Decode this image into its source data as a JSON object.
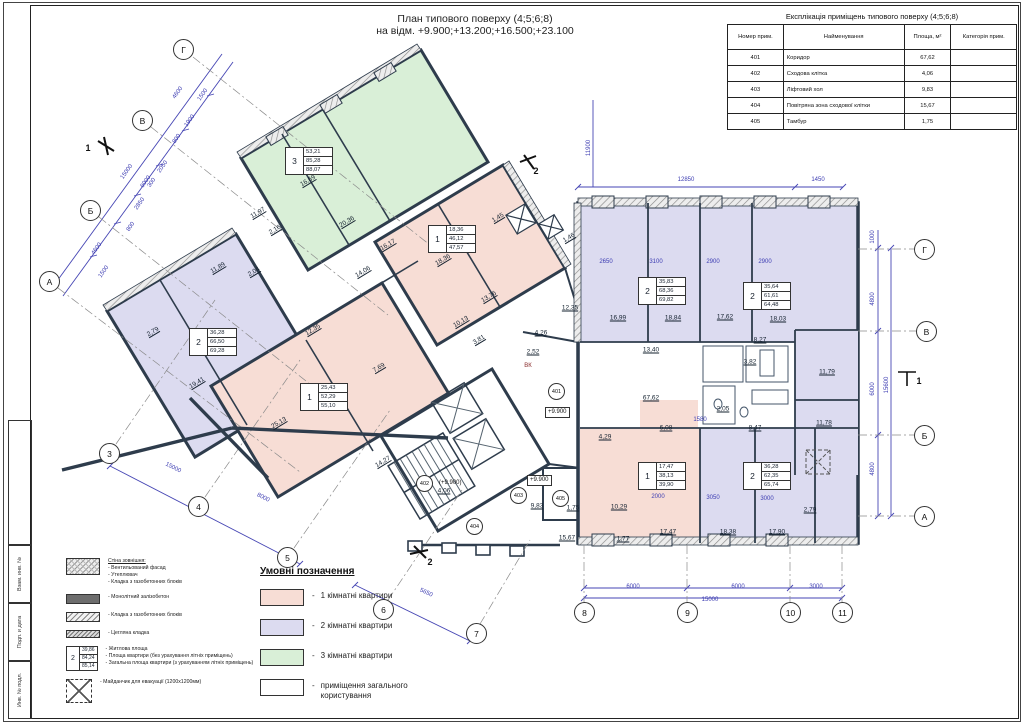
{
  "title": {
    "line1": "План типового поверху (4;5;6;8)",
    "line2": "на відм. +9.900;+13.200;+16.500;+23.100"
  },
  "stamp": {
    "fields": [
      "Взам. инв. №",
      "Подп. и дата",
      "Инв. № подл."
    ]
  },
  "expl_table": {
    "title": "Експлікація приміщень типового поверху (4;5;6;8)",
    "columns": [
      "Номер прим.",
      "Найменування",
      "Площа, м²",
      "Категорія прим."
    ],
    "rows": [
      [
        "401",
        "Коридор",
        "67,62",
        ""
      ],
      [
        "402",
        "Сходова клітка",
        "4,06",
        ""
      ],
      [
        "403",
        "Ліфтовий хол",
        "9,83",
        ""
      ],
      [
        "404",
        "Повітряна зона сходової клітки",
        "15,67",
        ""
      ],
      [
        "405",
        "Тамбур",
        "1,75",
        ""
      ]
    ]
  },
  "legend": {
    "title": "Умовні позначення",
    "items": [
      {
        "color": "#f7ddd5",
        "label": "1 кімнатні квартири"
      },
      {
        "color": "#dcdbf0",
        "label": "2 кімнатні квартири"
      },
      {
        "color": "#d9efd7",
        "label": "3 кімнатні квартири"
      },
      {
        "color": "#ffffff",
        "label": "приміщення загального користування"
      }
    ]
  },
  "materials": {
    "items": [
      {
        "swatch": "sw-wallext",
        "lines": [
          "Стіна зовнішня:",
          "- Вентильований фасад",
          "- Утеплювач",
          "- Кладка з газобетонних блоків"
        ]
      },
      {
        "swatch": "sw-conc",
        "lines": [
          "- Монолітний залізобетон"
        ]
      },
      {
        "swatch": "sw-aer",
        "lines": [
          "- Кладка з газобетонних блоків"
        ]
      },
      {
        "swatch": "sw-brick",
        "lines": [
          "- Цегляна кладка"
        ]
      },
      {
        "swatch": "mini-tag",
        "tag": {
          "num": "2",
          "values": [
            "39,86",
            "84,24",
            "85,14"
          ]
        },
        "lines": [
          "- Житлова площа",
          "- Площа квартири (без урахування літніх приміщень)",
          "- Загальна площа квартири (з урахуванням літніх приміщень)"
        ]
      },
      {
        "swatch": "sw-evac",
        "lines": [
          "- Майданчик для евакуації (1200х1200мм)"
        ]
      }
    ]
  },
  "plan": {
    "axes": [
      {
        "label": "Г",
        "x": 183,
        "y": 49
      },
      {
        "label": "В",
        "x": 142,
        "y": 120
      },
      {
        "label": "Б",
        "x": 90,
        "y": 210
      },
      {
        "label": "А",
        "x": 49,
        "y": 281
      },
      {
        "label": "3",
        "x": 109,
        "y": 453
      },
      {
        "label": "4",
        "x": 198,
        "y": 506
      },
      {
        "label": "5",
        "x": 287,
        "y": 557
      },
      {
        "label": "6",
        "x": 383,
        "y": 609
      },
      {
        "label": "7",
        "x": 476,
        "y": 633
      },
      {
        "label": "8",
        "x": 584,
        "y": 612
      },
      {
        "label": "9",
        "x": 687,
        "y": 612
      },
      {
        "label": "10",
        "x": 790,
        "y": 612
      },
      {
        "label": "11",
        "x": 842,
        "y": 612
      },
      {
        "label": "Г",
        "x": 924,
        "y": 249
      },
      {
        "label": "В",
        "x": 926,
        "y": 331
      },
      {
        "label": "Б",
        "x": 924,
        "y": 435
      },
      {
        "label": "А",
        "x": 924,
        "y": 516
      }
    ],
    "apt_tags": [
      {
        "num": "3",
        "values": [
          "53,21",
          "85,28",
          "88,07"
        ],
        "x": 285,
        "y": 147
      },
      {
        "num": "2",
        "values": [
          "36,28",
          "66,50",
          "69,28"
        ],
        "x": 189,
        "y": 328
      },
      {
        "num": "1",
        "values": [
          "25,43",
          "52,29",
          "55,10"
        ],
        "x": 300,
        "y": 383
      },
      {
        "num": "1",
        "values": [
          "18,36",
          "46,12",
          "47,57"
        ],
        "x": 428,
        "y": 225
      },
      {
        "num": "2",
        "values": [
          "35,83",
          "68,36",
          "69,82"
        ],
        "x": 638,
        "y": 277
      },
      {
        "num": "2",
        "values": [
          "35,64",
          "61,61",
          "64,48"
        ],
        "x": 743,
        "y": 282
      },
      {
        "num": "1",
        "values": [
          "17,47",
          "38,13",
          "39,90"
        ],
        "x": 638,
        "y": 462
      },
      {
        "num": "2",
        "values": [
          "36,28",
          "62,35",
          "65,74"
        ],
        "x": 743,
        "y": 462
      }
    ],
    "room_circles": [
      {
        "t": "401",
        "x": 556,
        "y": 391
      },
      {
        "t": "402",
        "x": 424,
        "y": 483
      },
      {
        "t": "403",
        "x": 518,
        "y": 495
      },
      {
        "t": "404",
        "x": 474,
        "y": 526
      },
      {
        "t": "405",
        "x": 560,
        "y": 498
      }
    ],
    "elev_marks": [
      {
        "t": "+9.900",
        "x": 545,
        "y": 412,
        "box": true
      },
      {
        "t": "+9.900",
        "x": 527,
        "y": 480,
        "box": true
      },
      {
        "t": "(+9.900)",
        "x": 437,
        "y": 484,
        "box": false
      }
    ],
    "labels": [
      {
        "t": "16,69",
        "x": 308,
        "y": 181,
        "r": -31,
        "c": "a"
      },
      {
        "t": "20,36",
        "x": 347,
        "y": 222,
        "r": -31,
        "c": "a"
      },
      {
        "t": "11,97",
        "x": 258,
        "y": 213,
        "r": -31,
        "c": "a"
      },
      {
        "t": "16,17",
        "x": 388,
        "y": 245,
        "r": -31,
        "c": "a"
      },
      {
        "t": "14,06",
        "x": 363,
        "y": 272,
        "r": -31,
        "c": "a"
      },
      {
        "t": "2,16",
        "x": 275,
        "y": 230,
        "r": -31,
        "c": "a"
      },
      {
        "t": "11,89",
        "x": 218,
        "y": 268,
        "r": -31,
        "c": "a"
      },
      {
        "t": "2,04",
        "x": 254,
        "y": 272,
        "r": -31,
        "c": "a"
      },
      {
        "t": "19,41",
        "x": 197,
        "y": 383,
        "r": -31,
        "c": "a"
      },
      {
        "t": "2,79",
        "x": 153,
        "y": 332,
        "r": -31,
        "c": "a"
      },
      {
        "t": "25,13",
        "x": 279,
        "y": 423,
        "r": -31,
        "c": "a"
      },
      {
        "t": "7,69",
        "x": 379,
        "y": 368,
        "r": -31,
        "c": "a"
      },
      {
        "t": "14,27",
        "x": 383,
        "y": 462,
        "r": -31,
        "c": "a"
      },
      {
        "t": "18,36",
        "x": 443,
        "y": 260,
        "r": -31,
        "c": "a"
      },
      {
        "t": "13,76",
        "x": 489,
        "y": 297,
        "r": -31,
        "c": "a"
      },
      {
        "t": "10,13",
        "x": 461,
        "y": 322,
        "r": -31,
        "c": "a"
      },
      {
        "t": "3,81",
        "x": 479,
        "y": 340,
        "r": -31,
        "c": "a"
      },
      {
        "t": "12,35",
        "x": 313,
        "y": 330,
        "r": -31,
        "c": "a"
      },
      {
        "t": "1,45",
        "x": 498,
        "y": 218,
        "r": -31,
        "c": "a"
      },
      {
        "t": "1,46",
        "x": 569,
        "y": 238,
        "r": -31,
        "c": "a"
      },
      {
        "t": "4,26",
        "x": 541,
        "y": 333,
        "c": "a"
      },
      {
        "t": "2,52",
        "x": 533,
        "y": 352,
        "c": "a"
      },
      {
        "t": "12,35",
        "x": 570,
        "y": 308,
        "c": "a"
      },
      {
        "t": "4,06",
        "x": 444,
        "y": 491,
        "c": "a"
      },
      {
        "t": "9,83",
        "x": 537,
        "y": 506,
        "c": "a"
      },
      {
        "t": "1,75",
        "x": 573,
        "y": 508,
        "c": "a"
      },
      {
        "t": "15,67",
        "x": 567,
        "y": 538,
        "c": "a"
      },
      {
        "t": "4,29",
        "x": 605,
        "y": 437,
        "c": "a"
      },
      {
        "t": "16,99",
        "x": 618,
        "y": 318,
        "c": "a"
      },
      {
        "t": "18,84",
        "x": 673,
        "y": 318,
        "c": "a"
      },
      {
        "t": "13,40",
        "x": 651,
        "y": 350,
        "c": "a"
      },
      {
        "t": "17,62",
        "x": 725,
        "y": 317,
        "c": "a"
      },
      {
        "t": "18,03",
        "x": 778,
        "y": 319,
        "c": "a"
      },
      {
        "t": "8,27",
        "x": 760,
        "y": 340,
        "c": "a"
      },
      {
        "t": "3,82",
        "x": 750,
        "y": 362,
        "c": "a"
      },
      {
        "t": "2,05",
        "x": 723,
        "y": 409,
        "c": "a"
      },
      {
        "t": "67,62",
        "x": 651,
        "y": 398,
        "c": "a"
      },
      {
        "t": "6,08",
        "x": 666,
        "y": 428,
        "c": "a"
      },
      {
        "t": "8,47",
        "x": 755,
        "y": 428,
        "c": "a"
      },
      {
        "t": "11,79",
        "x": 827,
        "y": 372,
        "c": "a"
      },
      {
        "t": "11,78",
        "x": 824,
        "y": 423,
        "c": "a"
      },
      {
        "t": "17,47",
        "x": 668,
        "y": 532,
        "c": "a"
      },
      {
        "t": "18,38",
        "x": 728,
        "y": 532,
        "c": "a"
      },
      {
        "t": "17,90",
        "x": 777,
        "y": 532,
        "c": "a"
      },
      {
        "t": "10,29",
        "x": 619,
        "y": 507,
        "c": "a"
      },
      {
        "t": "1,77",
        "x": 623,
        "y": 539,
        "c": "a"
      },
      {
        "t": "2,79",
        "x": 810,
        "y": 510,
        "c": "a"
      },
      {
        "t": "6000",
        "x": 633,
        "y": 587,
        "c": "d"
      },
      {
        "t": "6000",
        "x": 738,
        "y": 587,
        "c": "d"
      },
      {
        "t": "3000",
        "x": 816,
        "y": 587,
        "c": "d"
      },
      {
        "t": "15000",
        "x": 710,
        "y": 600,
        "c": "d"
      },
      {
        "t": "12850",
        "x": 686,
        "y": 180,
        "c": "d"
      },
      {
        "t": "1450",
        "x": 818,
        "y": 180,
        "c": "d"
      },
      {
        "t": "11900",
        "x": 589,
        "y": 148,
        "r": -90,
        "c": "d"
      },
      {
        "t": "1000",
        "x": 873,
        "y": 237,
        "r": -90,
        "c": "d"
      },
      {
        "t": "4800",
        "x": 873,
        "y": 299,
        "r": -90,
        "c": "d"
      },
      {
        "t": "6000",
        "x": 873,
        "y": 389,
        "r": -90,
        "c": "d"
      },
      {
        "t": "4800",
        "x": 873,
        "y": 469,
        "r": -90,
        "c": "d"
      },
      {
        "t": "15600",
        "x": 887,
        "y": 385,
        "r": -90,
        "c": "d"
      },
      {
        "t": "2650",
        "x": 606,
        "y": 262,
        "c": "d"
      },
      {
        "t": "3100",
        "x": 656,
        "y": 262,
        "c": "d"
      },
      {
        "t": "2900",
        "x": 713,
        "y": 262,
        "c": "d"
      },
      {
        "t": "2900",
        "x": 765,
        "y": 262,
        "c": "d"
      },
      {
        "t": "2000",
        "x": 658,
        "y": 497,
        "c": "d"
      },
      {
        "t": "3050",
        "x": 713,
        "y": 498,
        "c": "d"
      },
      {
        "t": "3000",
        "x": 767,
        "y": 499,
        "c": "d"
      },
      {
        "t": "1580",
        "x": 700,
        "y": 420,
        "c": "d"
      },
      {
        "t": "4600",
        "x": 178,
        "y": 93,
        "r": -55,
        "c": "d"
      },
      {
        "t": "1500",
        "x": 203,
        "y": 95,
        "r": -55,
        "c": "d"
      },
      {
        "t": "1900",
        "x": 190,
        "y": 121,
        "r": -55,
        "c": "d"
      },
      {
        "t": "800",
        "x": 177,
        "y": 139,
        "r": -55,
        "c": "d"
      },
      {
        "t": "2050",
        "x": 163,
        "y": 167,
        "r": -55,
        "c": "d"
      },
      {
        "t": "300",
        "x": 152,
        "y": 183,
        "r": -55,
        "c": "d"
      },
      {
        "t": "2850",
        "x": 140,
        "y": 204,
        "r": -55,
        "c": "d"
      },
      {
        "t": "800",
        "x": 131,
        "y": 227,
        "r": -55,
        "c": "d"
      },
      {
        "t": "4600",
        "x": 97,
        "y": 249,
        "r": -55,
        "c": "d"
      },
      {
        "t": "1500",
        "x": 104,
        "y": 272,
        "r": -55,
        "c": "d"
      },
      {
        "t": "15000",
        "x": 127,
        "y": 172,
        "r": -55,
        "c": "d"
      },
      {
        "t": "6000",
        "x": 146,
        "y": 182,
        "r": -55,
        "c": "d"
      },
      {
        "t": "15000",
        "x": 173,
        "y": 468,
        "r": 27,
        "c": "d"
      },
      {
        "t": "8000",
        "x": 263,
        "y": 498,
        "r": 27,
        "c": "d"
      },
      {
        "t": "5650",
        "x": 426,
        "y": 593,
        "r": 25,
        "c": "d"
      },
      {
        "t": "ВК",
        "x": 528,
        "y": 366,
        "c": "p"
      },
      {
        "t": "1",
        "x": 88,
        "y": 148,
        "c": "s"
      },
      {
        "t": "1",
        "x": 919,
        "y": 381,
        "c": "s"
      },
      {
        "t": "2",
        "x": 536,
        "y": 171,
        "c": "s"
      },
      {
        "t": "2",
        "x": 430,
        "y": 562,
        "c": "s"
      }
    ]
  }
}
